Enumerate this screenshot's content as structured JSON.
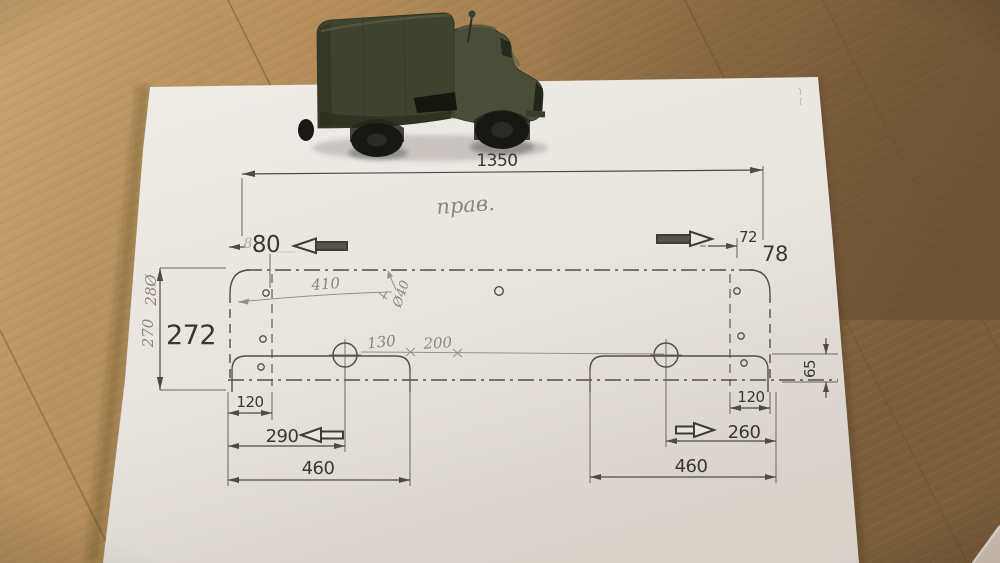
{
  "scene": {
    "description_labels": {
      "paper": "drawing-sheet",
      "truck": "olive-model-truck",
      "floor": "wood-laminate-floor"
    }
  },
  "drawing": {
    "dims": {
      "overall_width": "1350",
      "overall_height": "272",
      "height_hw_inner": "270",
      "height_hw_outer": "28Ø",
      "left_hole_offset": "80",
      "left_hole_offset_hw": "8",
      "right_hole_offset": "72",
      "right_edge_offset": "78",
      "left_inset": "120",
      "left_slot": "290",
      "left_flap": "460",
      "right_inset": "120",
      "right_slot": "260",
      "right_flap": "460",
      "flap_depth": "65"
    },
    "pencil": {
      "side_label": "прав.",
      "hole_span": "410",
      "hole_dia": "Ø40",
      "seg_a": "130",
      "seg_b": "200"
    }
  }
}
